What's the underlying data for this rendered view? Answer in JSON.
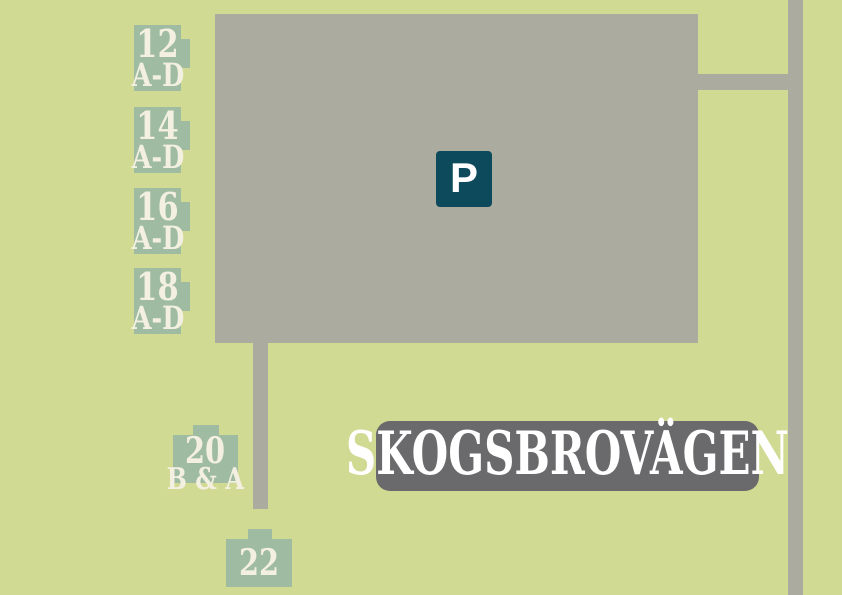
{
  "map": {
    "street_sign": {
      "label": "SKOGSBROVÄGEN"
    },
    "parking_sign": {
      "label": "P"
    },
    "buildings": [
      {
        "name": "building-12",
        "number": "12",
        "units": "A-D"
      },
      {
        "name": "building-14",
        "number": "14",
        "units": "A-D"
      },
      {
        "name": "building-16",
        "number": "16",
        "units": "A-D"
      },
      {
        "name": "building-18",
        "number": "18",
        "units": "A-D"
      },
      {
        "name": "building-20",
        "number": "20",
        "units": "B & A"
      },
      {
        "name": "building-22",
        "number": "22",
        "units": ""
      }
    ],
    "colors": {
      "background": "#d1da92",
      "road": "#abab9f",
      "parking": "#abab9f",
      "building": "#9fbca3",
      "building_text": "#f4f0e1",
      "parking_sign_bg": "#0d4a5c",
      "parking_sign_text": "#ffffff",
      "street_sign_bg": "#6a696b",
      "street_sign_text": "#ffffff"
    }
  }
}
